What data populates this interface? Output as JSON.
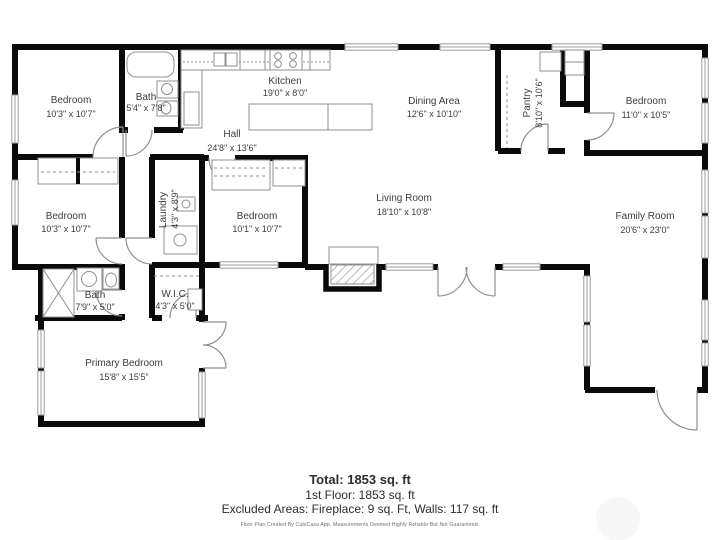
{
  "colors": {
    "wall": "#0a0a0a",
    "fixture_line": "#8f8f8f",
    "window_line": "#9c9c9c",
    "label_text": "#3c3c3c"
  },
  "rooms": {
    "bedroom_top_left": {
      "name": "Bedroom",
      "dims": "10'3\" x 10'7\""
    },
    "bath_top": {
      "name": "Bath",
      "dims": "5'4\" x 7'8\""
    },
    "kitchen": {
      "name": "Kitchen",
      "dims": "19'0\" x 8'0\""
    },
    "dining": {
      "name": "Dining Area",
      "dims": "12'6\" x 10'10\""
    },
    "pantry": {
      "name": "Pantry",
      "dims": "8'10\" x 10'6\""
    },
    "bedroom_top_right": {
      "name": "Bedroom",
      "dims": "11'0\" x 10'5\""
    },
    "hall": {
      "name": "Hall",
      "dims": "24'8\" x 13'6\""
    },
    "bedroom_mid_left": {
      "name": "Bedroom",
      "dims": "10'3\" x 10'7\""
    },
    "laundry": {
      "name": "Laundry",
      "dims": "4'3\" x 8'9\""
    },
    "bedroom_mid": {
      "name": "Bedroom",
      "dims": "10'1\" x 10'7\""
    },
    "living_room": {
      "name": "Living Room",
      "dims": "18'10\" x 10'8\""
    },
    "family_room": {
      "name": "Family Room",
      "dims": "20'6\" x 23'0\""
    },
    "bath_lower": {
      "name": "Bath",
      "dims": "7'9\" x 5'0\""
    },
    "wic": {
      "name": "W.I.C.",
      "dims": "4'3\" x 5'0\""
    },
    "primary_bedroom": {
      "name": "Primary Bedroom",
      "dims": "15'8\" x 15'5\""
    }
  },
  "summary": {
    "total": "Total: 1853 sq. ft",
    "first_floor": "1st Floor: 1853 sq. ft",
    "excluded": "Excluded Areas: Fireplace: 9 sq. Ft, Walls: 117 sq. ft",
    "disclaimer": "Floor Plan Created By CubiCasa App. Measurements Deemed Highly Reliable But Not Guaranteed."
  }
}
